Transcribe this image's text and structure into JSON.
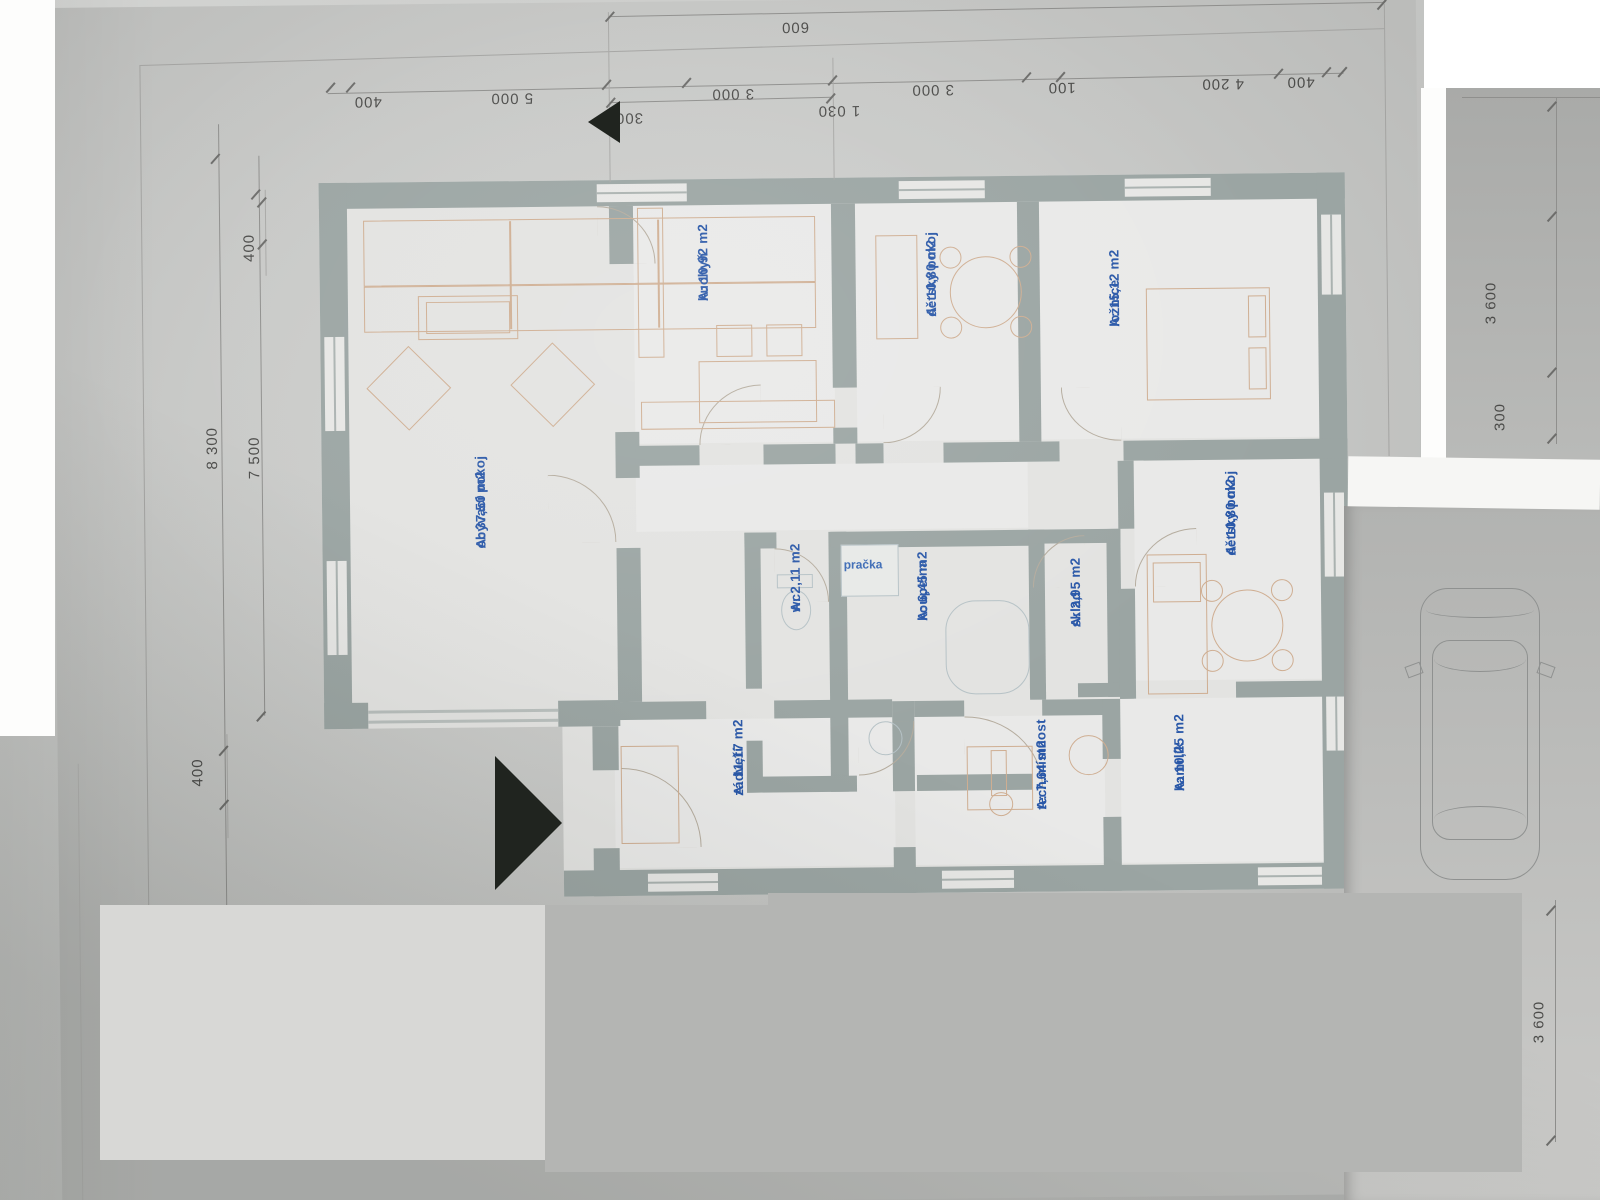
{
  "plan": {
    "rooms": [
      {
        "name": "obývací pokoj",
        "area": "A: 37,50 m2"
      },
      {
        "name": "kuchyň",
        "area": "A: 10,92 m2"
      },
      {
        "name": "dětský pokoj",
        "area": "A: 10,80 m2"
      },
      {
        "name": "ložnice",
        "area": "A: 15,12 m2"
      },
      {
        "name": "wc",
        "area": "A: 2,11 m2"
      },
      {
        "name": "koupelna",
        "area": "A: 6,45 m2"
      },
      {
        "name": "sklad",
        "area": "A: 2,95 m2"
      },
      {
        "name": "dětský pokoj",
        "area": "A: 10,80 m2"
      },
      {
        "name": "zádveří",
        "area": "A: 11,17 m2"
      },
      {
        "name": "tech.místnost",
        "area": "A: 7,64 m2"
      },
      {
        "name": "kamrlík",
        "area": "A: 10,25 m2"
      }
    ],
    "appliances": {
      "washer": "pračka"
    },
    "dimensions": {
      "top_chain": [
        "400",
        "5 000",
        "300",
        "3 000",
        "3 000",
        "100",
        "4 200",
        "400"
      ],
      "top_outer": "600",
      "top_inner": "1 030",
      "left_top": "400",
      "left_outer": "8 300",
      "left_inner": "7 500",
      "left_bottom": "400",
      "right_upper": "3 600",
      "right_small": "300",
      "right_lower": "3 600"
    }
  },
  "colors": {
    "label_blue": "#2a58a8",
    "wall_gray": "#9ba5a3",
    "furniture_tan": "#cfae92",
    "paper": "#c8c9c7"
  }
}
